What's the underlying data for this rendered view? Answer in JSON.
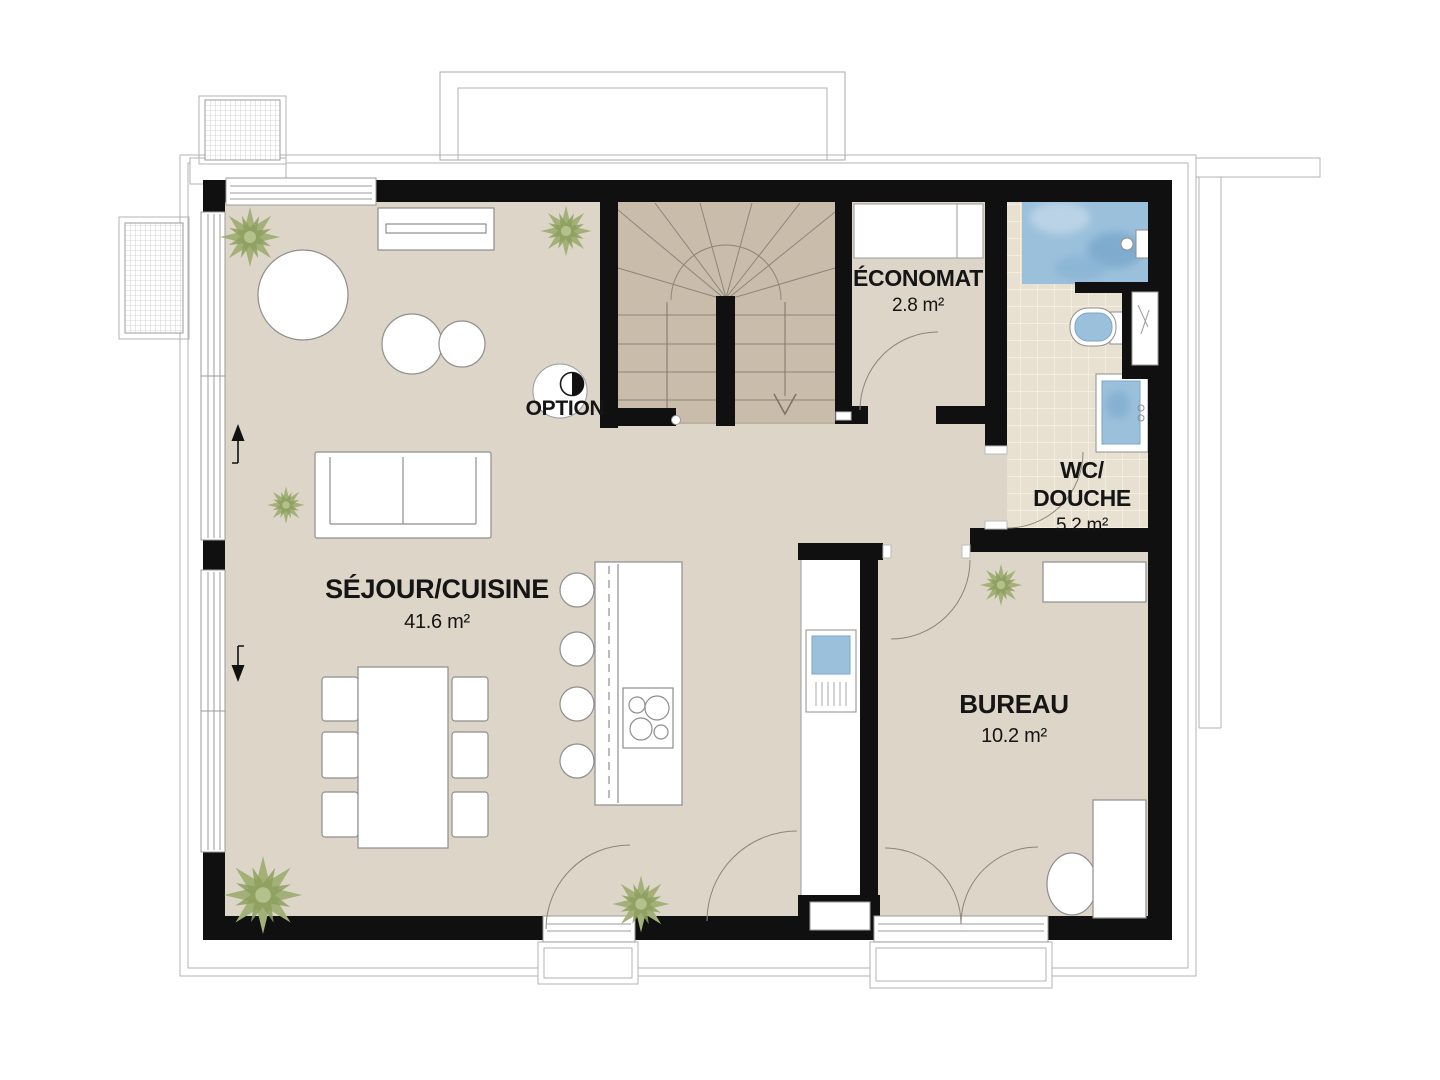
{
  "floorplan": {
    "rooms": {
      "living": {
        "name": "SÉJOUR/CUISINE",
        "area": "41.6 m²"
      },
      "storage": {
        "name": "ÉCONOMAT",
        "area": "2.8 m²"
      },
      "bathroom": {
        "name_line1": "WC/",
        "name_line2": "DOUCHE",
        "area": "5.2 m²"
      },
      "office": {
        "name": "BUREAU",
        "area": "10.2 m²"
      }
    },
    "annotations": {
      "option_label": "OPTION"
    },
    "colors": {
      "floor": "#dcd5c8",
      "stair_floor": "#c9bcab",
      "tile_floor": "#e8e1d2",
      "wall": "#101010",
      "outline_gray": "#9b9b9b",
      "fixture_blue": "#9bc0dc",
      "fixture_blue_deep": "#78a7cb",
      "plant_green": "#a3b077"
    }
  }
}
